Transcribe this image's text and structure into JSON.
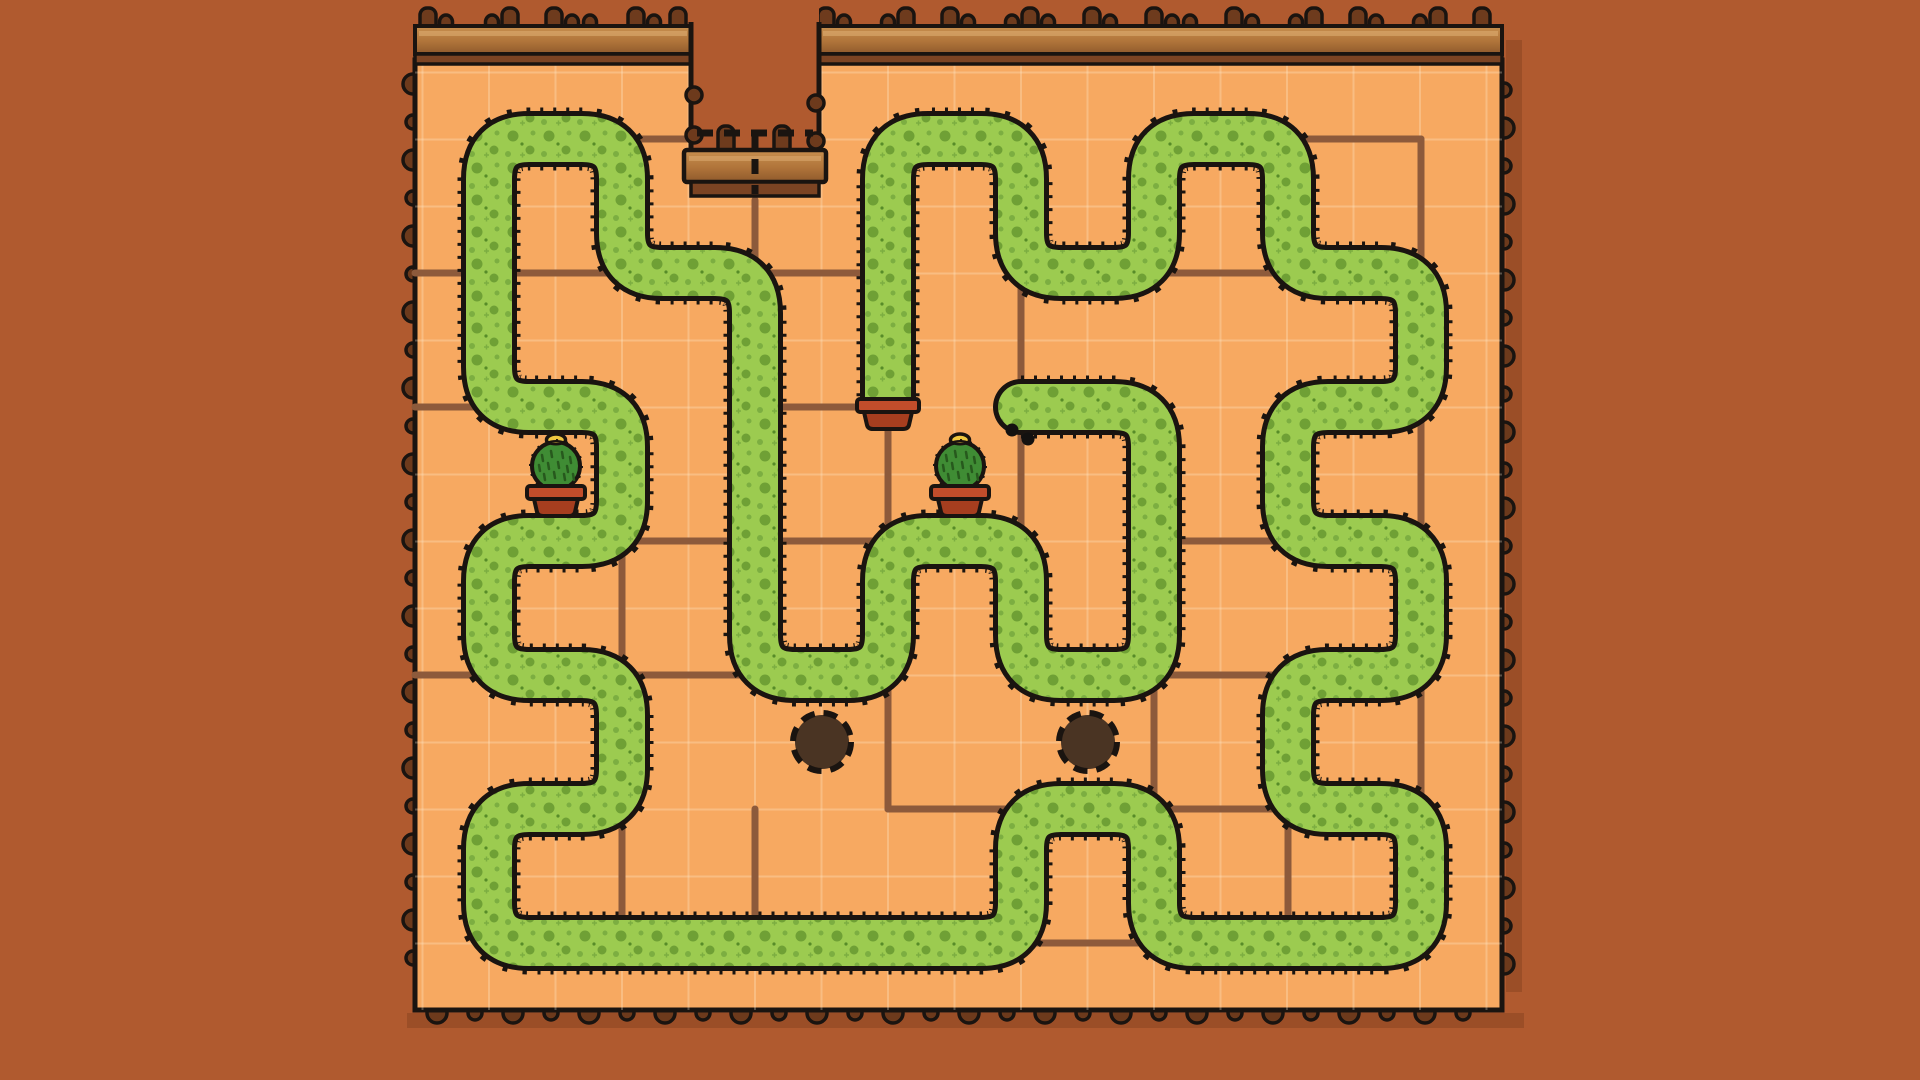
{
  "scene": "garden-hedge-maze",
  "colors": {
    "background": "#b05a2f",
    "field": "#f7a961",
    "seam": "rgba(255,240,215,0.28)",
    "outline": "#1a1410",
    "path_brown": "#8d5a3b",
    "hedge_green": "#9ccb50",
    "hedge_dot": "#6fa035",
    "hedge_dot2": "#7cae41",
    "wood_light": "#c8904f",
    "wood_mid": "#b0743a",
    "wood_dark": "#8f5a2c",
    "wood_strip": "#7c4423",
    "post": "#6e3b1d",
    "bump": "#6d3a1c",
    "hole_fill": "#4a3423",
    "pot_rim": "#c24d2b",
    "pot_body": "#a63e1f",
    "cactus": "#3f8c34",
    "cactus_spine": "#27591d",
    "flower": "#efc73f",
    "eye": "#131110",
    "shadow": "rgba(60,25,5,0.18)"
  },
  "field": {
    "x": 415,
    "y": 60,
    "w": 1087,
    "h": 950,
    "seam_step_x": 66.5,
    "seam_step_y": 67
  },
  "lattice": {
    "cols": [
      489,
      622,
      755,
      888,
      1021,
      1154,
      1288,
      1421
    ],
    "rows": [
      139,
      273,
      407,
      541,
      675,
      809,
      943
    ]
  },
  "hedge": {
    "stroke_green": 46,
    "stroke_outline": 56,
    "stroke_spikes": 63,
    "corner_radius": 40,
    "spike_dash": [
      3,
      10
    ],
    "points": [
      [
        1021,
        407
      ],
      [
        1154,
        407
      ],
      [
        1154,
        675
      ],
      [
        1021,
        675
      ],
      [
        1021,
        541
      ],
      [
        888,
        541
      ],
      [
        888,
        675
      ],
      [
        755,
        675
      ],
      [
        755,
        273
      ],
      [
        622,
        273
      ],
      [
        622,
        139
      ],
      [
        489,
        139
      ],
      [
        489,
        407
      ],
      [
        622,
        407
      ],
      [
        622,
        541
      ],
      [
        489,
        541
      ],
      [
        489,
        675
      ],
      [
        622,
        675
      ],
      [
        622,
        809
      ],
      [
        489,
        809
      ],
      [
        489,
        943
      ],
      [
        1021,
        943
      ],
      [
        1021,
        809
      ],
      [
        1154,
        809
      ],
      [
        1154,
        943
      ],
      [
        1421,
        943
      ],
      [
        1421,
        809
      ],
      [
        1288,
        809
      ],
      [
        1288,
        675
      ],
      [
        1421,
        675
      ],
      [
        1421,
        541
      ],
      [
        1288,
        541
      ],
      [
        1288,
        407
      ],
      [
        1421,
        407
      ],
      [
        1421,
        273
      ],
      [
        1288,
        273
      ],
      [
        1288,
        139
      ],
      [
        1154,
        139
      ],
      [
        1154,
        273
      ],
      [
        1021,
        273
      ],
      [
        1021,
        139
      ],
      [
        888,
        139
      ],
      [
        888,
        400
      ]
    ],
    "eyes": [
      {
        "x": 1012,
        "y": 430,
        "r": 6.5
      },
      {
        "x": 1028,
        "y": 439,
        "r": 6.5
      }
    ]
  },
  "brown_paths": [
    [
      628,
      139,
      691,
      139
    ],
    [
      1288,
      139,
      1421,
      139
    ],
    [
      415,
      273,
      622,
      273
    ],
    [
      755,
      273,
      888,
      273
    ],
    [
      1154,
      273,
      1288,
      273
    ],
    [
      415,
      407,
      489,
      407
    ],
    [
      755,
      407,
      888,
      407
    ],
    [
      622,
      541,
      1021,
      541
    ],
    [
      1154,
      541,
      1288,
      541
    ],
    [
      415,
      675,
      489,
      675
    ],
    [
      622,
      675,
      755,
      675
    ],
    [
      1154,
      675,
      1288,
      675
    ],
    [
      888,
      809,
      1021,
      809
    ],
    [
      1154,
      809,
      1288,
      809
    ],
    [
      1021,
      943,
      1154,
      943
    ],
    [
      755,
      200,
      755,
      273
    ],
    [
      888,
      407,
      888,
      541
    ],
    [
      1021,
      273,
      1021,
      541
    ],
    [
      622,
      541,
      622,
      675
    ],
    [
      622,
      809,
      622,
      943
    ],
    [
      888,
      675,
      888,
      809
    ],
    [
      1154,
      675,
      1154,
      809
    ],
    [
      1288,
      809,
      1288,
      943
    ],
    [
      755,
      809,
      755,
      943
    ],
    [
      1421,
      139,
      1421,
      273
    ],
    [
      1421,
      407,
      1421,
      541
    ],
    [
      1421,
      675,
      1421,
      809
    ]
  ],
  "holes": [
    {
      "x": 822,
      "y": 742,
      "r": 27
    },
    {
      "x": 1088,
      "y": 742,
      "r": 27
    }
  ],
  "cacti": [
    {
      "x": 556,
      "y": 486
    },
    {
      "x": 960,
      "y": 486
    }
  ],
  "tail_pot": {
    "x": 888,
    "y": 399
  },
  "fence": {
    "bar_y": 26,
    "bar_h": 28,
    "strip_h": 10,
    "segments": [
      [
        415,
        691
      ],
      [
        819,
        1502
      ]
    ],
    "posts": [
      [
        428,
        "t"
      ],
      [
        446,
        "s"
      ],
      [
        492,
        "s"
      ],
      [
        510,
        "t"
      ],
      [
        554,
        "t"
      ],
      [
        572,
        "s"
      ],
      [
        590,
        "s"
      ],
      [
        636,
        "t"
      ],
      [
        654,
        "s"
      ],
      [
        678,
        "t"
      ],
      [
        826,
        "t"
      ],
      [
        844,
        "s"
      ],
      [
        888,
        "s"
      ],
      [
        906,
        "t"
      ],
      [
        950,
        "t"
      ],
      [
        968,
        "s"
      ],
      [
        1012,
        "s"
      ],
      [
        1030,
        "t"
      ],
      [
        1048,
        "s"
      ],
      [
        1092,
        "t"
      ],
      [
        1110,
        "s"
      ],
      [
        1154,
        "t"
      ],
      [
        1172,
        "s"
      ],
      [
        1190,
        "s"
      ],
      [
        1234,
        "t"
      ],
      [
        1252,
        "s"
      ],
      [
        1296,
        "s"
      ],
      [
        1314,
        "t"
      ],
      [
        1358,
        "t"
      ],
      [
        1376,
        "s"
      ],
      [
        1420,
        "s"
      ],
      [
        1438,
        "t"
      ],
      [
        1482,
        "t"
      ]
    ]
  },
  "notch": {
    "x1": 691,
    "x2": 819,
    "wall_top": 22,
    "wall_bottom": 152,
    "ledge": {
      "x": 684,
      "y": 150,
      "w": 142,
      "h": 32,
      "posts": [
        726,
        782
      ]
    },
    "strip": {
      "x": 691,
      "y": 182,
      "w": 128,
      "h": 14
    },
    "dash_h": {
      "x1": 697,
      "y": 133,
      "x2": 813
    },
    "dash_v": {
      "x": 755,
      "y1": 133,
      "y2": 194
    },
    "wall_bumps_left": [
      95,
      135
    ],
    "wall_bumps_right": [
      103,
      141
    ]
  },
  "edge_bumps": {
    "spacing": 38,
    "r_big": 10,
    "r_small": 7,
    "left_x": 413,
    "left_y0": 84,
    "left_y1": 992,
    "right_x": 1504,
    "right_y0": 90,
    "right_y1": 992,
    "bottom_y": 1013,
    "bottom_x0": 437,
    "bottom_x1": 1485
  }
}
